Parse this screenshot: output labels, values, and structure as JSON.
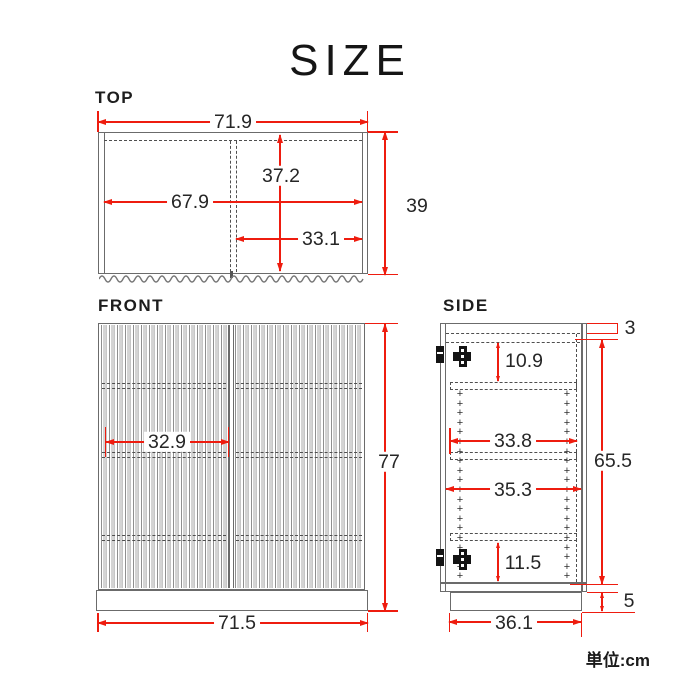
{
  "title": "SIZE",
  "unit": "単位:cm",
  "colors": {
    "dimension_red": "#ee1c0f",
    "line_gray": "#6b6b6b"
  },
  "views": {
    "top": {
      "label": "TOP",
      "dims": {
        "outer_width": "71.9",
        "inner_width": "67.9",
        "inner_depth": "37.2",
        "overall_depth": "39",
        "right_section_width": "33.1"
      }
    },
    "front": {
      "label": "FRONT",
      "dims": {
        "overall_height": "77",
        "door_width": "32.9",
        "base_width": "71.5"
      }
    },
    "side": {
      "label": "SIDE",
      "dims": {
        "top_thickness": "3",
        "top_to_shelf": "10.9",
        "shelf_depth": "33.8",
        "inner_depth": "35.3",
        "inner_height": "65.5",
        "shelf_to_bottom": "11.5",
        "base_height": "5",
        "base_depth": "36.1"
      },
      "pins": {
        "symbol": "+",
        "rows": 20
      }
    }
  }
}
